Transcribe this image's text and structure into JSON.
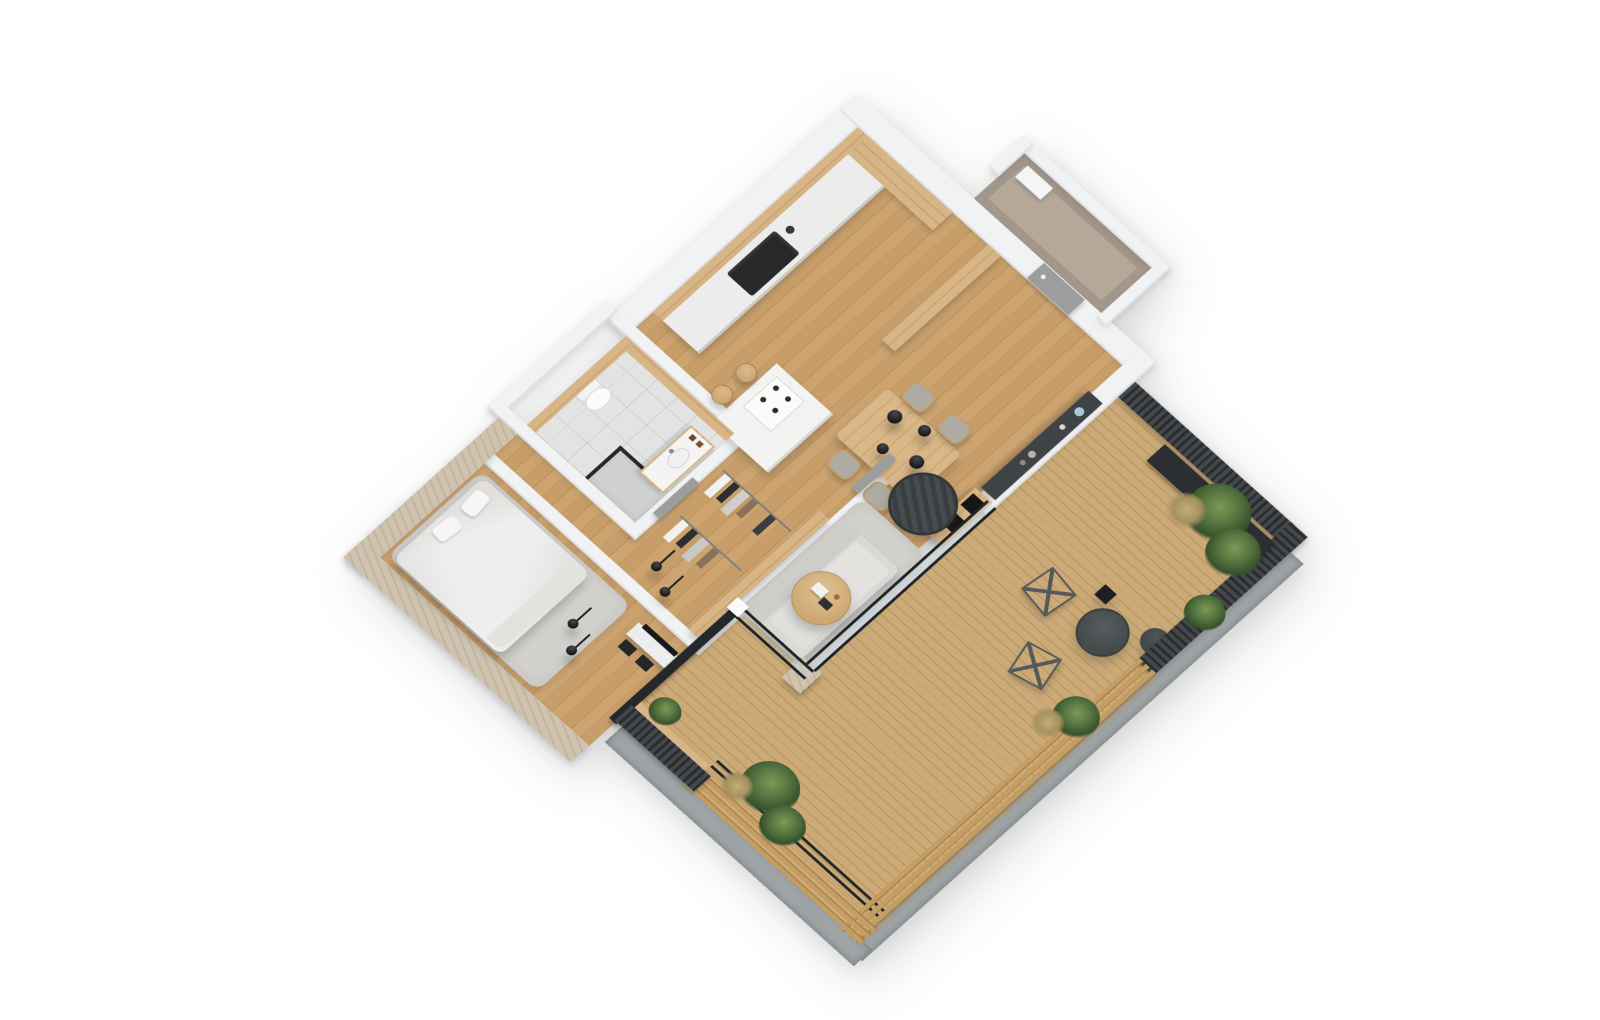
{
  "meta": {
    "title": "3D isometric floor plan render of a one-bedroom apartment with terrace",
    "view": "axonometric top view rotated 45 degrees on a white background",
    "background": "#ffffff"
  },
  "palette": {
    "wall": "#f1f2f3",
    "wall_edge": "#dfe1e3",
    "wood_floor": "#c79d68",
    "deck_wood": "#c3a170",
    "oak_cabinet": "#d2ae7e",
    "taupe_wall": "#a3968a",
    "taupe_floor": "#b5a898",
    "tile": "#e2e3e3",
    "charcoal_fence": "#383c3e",
    "black_frame": "#202324",
    "travertine": "#ccc0ad",
    "rug": "#d2d1ce",
    "sofa": "#dad9d6",
    "chair_gray": "#aeaba3",
    "lounge_charcoal": "#43484b",
    "glass": "rgba(198,214,218,0.42)",
    "concrete": "#9ea4a6",
    "plant_green": "#55713c",
    "accent_vase_blue": "#a8cdd8"
  },
  "rooms": [
    {
      "id": "entrance",
      "label": "Entrance storage room",
      "floor": "taupe"
    },
    {
      "id": "kitchen",
      "label": "Kitchen",
      "floor": "wood planks"
    },
    {
      "id": "living-dining",
      "label": "Living and dining room",
      "floor": "wood planks"
    },
    {
      "id": "bathroom",
      "label": "Bathroom",
      "floor": "gray tile"
    },
    {
      "id": "wardrobe-hall",
      "label": "Hallway with open wardrobe",
      "floor": "wood planks"
    },
    {
      "id": "bedroom",
      "label": "Bedroom",
      "floor": "wood planks"
    },
    {
      "id": "terrace",
      "label": "Wrap-around balcony terrace",
      "floor": "wood decking"
    }
  ],
  "furniture": {
    "entrance": [
      "white storage cabinet",
      "gray entry door"
    ],
    "kitchen": [
      "wall counter with black built-in sink",
      "oak tall cabinet wall",
      "oak upper cabinets",
      "cooktop island with four burners",
      "two wooden stools"
    ],
    "living_dining": [
      "wooden dining table",
      "four gray upholstered chairs",
      "four black pendant lamps",
      "charcoal wall sideboard with vases",
      "wood media bench with black cushions",
      "round charcoal lounge chair",
      "light gray area rug",
      "round oak coffee table with books",
      "light gray sofa",
      "travertine column"
    ],
    "bathroom": [
      "wall-hung toilet",
      "oak vanity with sink",
      "walk-in shower with black framed glass",
      "gray interior door"
    ],
    "wardrobe_hall": [
      "two clothes rails with hanging garments",
      "oak partition wall",
      "black pendant lights",
      "gray interior door"
    ],
    "bedroom": [
      "double bed with white duvet and pillows",
      "gray rug",
      "white TV console with black TV",
      "two black pendant lights"
    ],
    "terrace": [
      "diagonal wood deck boards",
      "black framed glass balustrade",
      "black metal railing",
      "charcoal vertical-slat fence",
      "light wood slat privacy screens",
      "concrete plinth border",
      "dark planter with ornamental grasses",
      "two wireframe lounge chairs",
      "large round charcoal table",
      "small round side table",
      "black cube side table",
      "green ornamental grass bushes"
    ]
  }
}
